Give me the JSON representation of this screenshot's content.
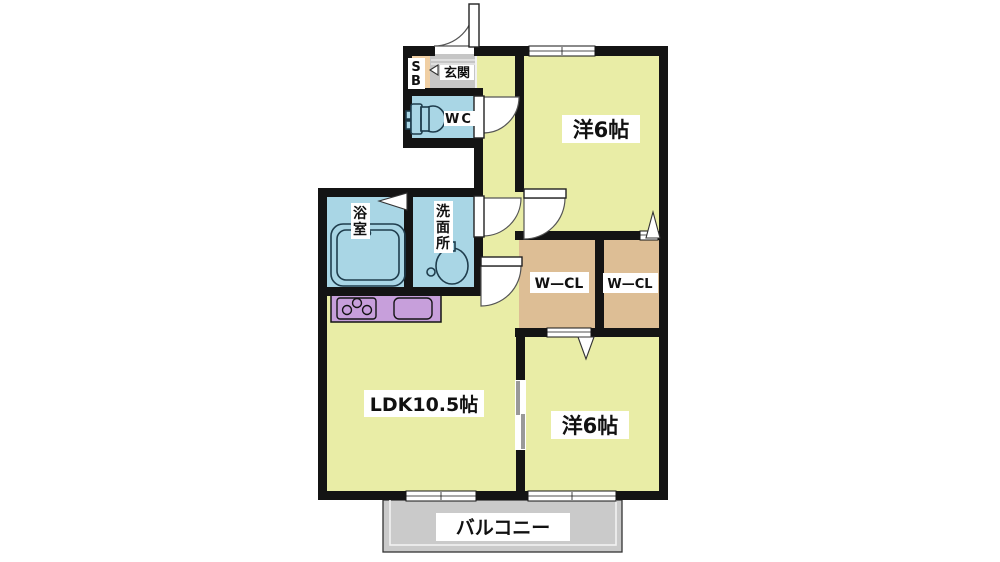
{
  "title": "2LDK apartment floor plan",
  "colors": {
    "room": "#E9EDA6",
    "wet": "#A9D6E5",
    "closet": "#DDBE95",
    "shoe_cabinet": "#F0CFA4",
    "entry_floor": "#C6C6C6",
    "counter": "#C79FDB",
    "balcony": "#CACACA",
    "wall": "#141414",
    "label_bg": "#FFFFFF",
    "text": "#111111"
  },
  "rooms": {
    "entrance": {
      "label": "玄関"
    },
    "shoe_box": {
      "chars": [
        "S",
        "B"
      ]
    },
    "toilet": {
      "label": "WC"
    },
    "bathroom": {
      "chars": [
        "浴",
        "室"
      ]
    },
    "washroom": {
      "chars": [
        "洗",
        "面",
        "所"
      ]
    },
    "bedroom_top": {
      "label": "洋6帖"
    },
    "bedroom_bottom": {
      "label": "洋6帖"
    },
    "closet_left": {
      "label": "W—CL"
    },
    "closet_right": {
      "label": "W—CL"
    },
    "ldk": {
      "label": "LDK10.5帖"
    },
    "balcony": {
      "label": "バルコニー"
    }
  }
}
